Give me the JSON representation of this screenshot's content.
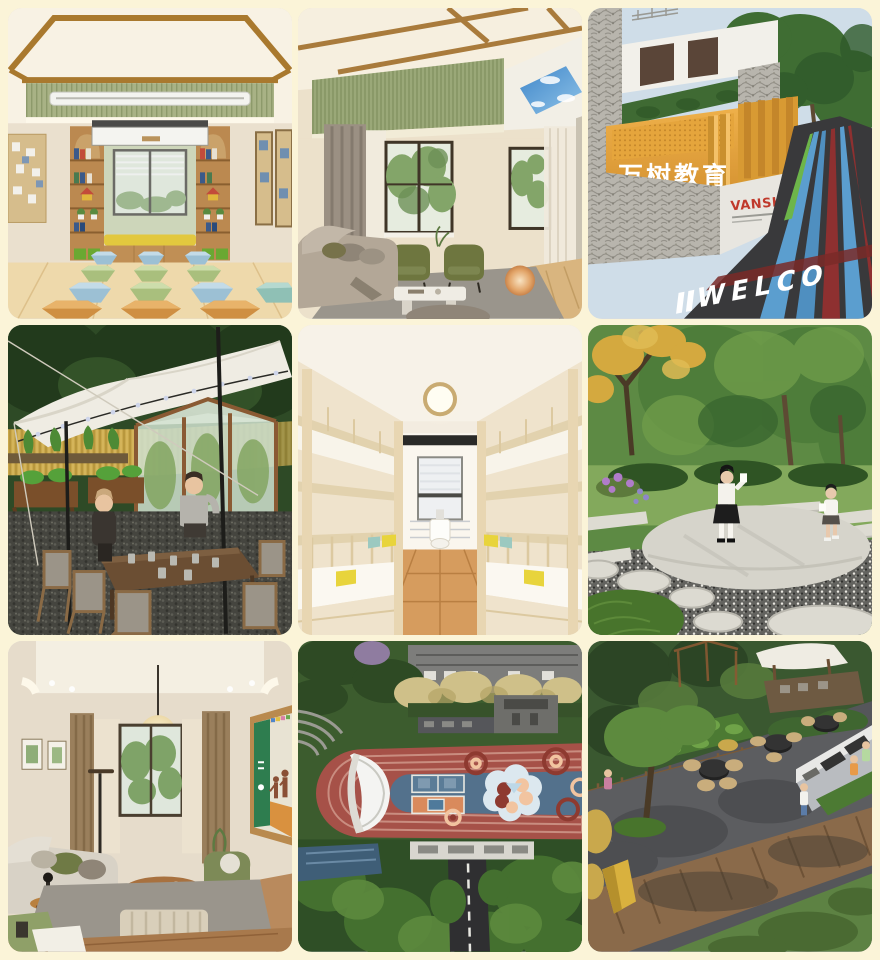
{
  "page": {
    "background_color": "#fbf4d8",
    "grid": "3x3 photo collage"
  },
  "gallery": {
    "tiles": [
      {
        "name": "classroom-reading-room",
        "alt": "Classroom with window bench, bookshelf arches and rows of hexagonal stools"
      },
      {
        "name": "living-room-lounge",
        "alt": "Lounge with olive armchairs, grey sofa, skylight ceiling panel"
      },
      {
        "name": "campus-entrance",
        "alt": "Campus entrance with stone walls, golden signage wall and striped welcome road"
      },
      {
        "name": "outdoor-tent-dining",
        "alt": "White canopy tent over a farm dining table beside a greenhouse and wheat field"
      },
      {
        "name": "dormitory-bunk-beds",
        "alt": "Dormitory corridor with wooden bunk beds on both sides"
      },
      {
        "name": "garden-reading-circle",
        "alt": "Round stone platform in a garden with two students reading"
      },
      {
        "name": "family-lounge",
        "alt": "Lounge with paper lantern pendant, sofa and family poster screen"
      },
      {
        "name": "playground-aerial",
        "alt": "Aerial view of red running track and blue patterned courts"
      },
      {
        "name": "bbq-terrace-aerial",
        "alt": "Aerial view of barbecue terrace, deck walkway and lawn"
      }
    ]
  },
  "signage": {
    "campus_name_cn": "万树教育",
    "brand_name": "VANSHU",
    "road_text": "WELCO"
  },
  "colors": {
    "background": "#fbf4d8",
    "gold_wall": "#e5a53c",
    "brand_red": "#c0392b",
    "track_red": "#a65148",
    "court_blue": "#53718c",
    "stool_orange": "#d8964a",
    "stool_blue": "#aecde0",
    "stool_green": "#b9cc8d",
    "bench_yellow": "#e2c83e"
  }
}
